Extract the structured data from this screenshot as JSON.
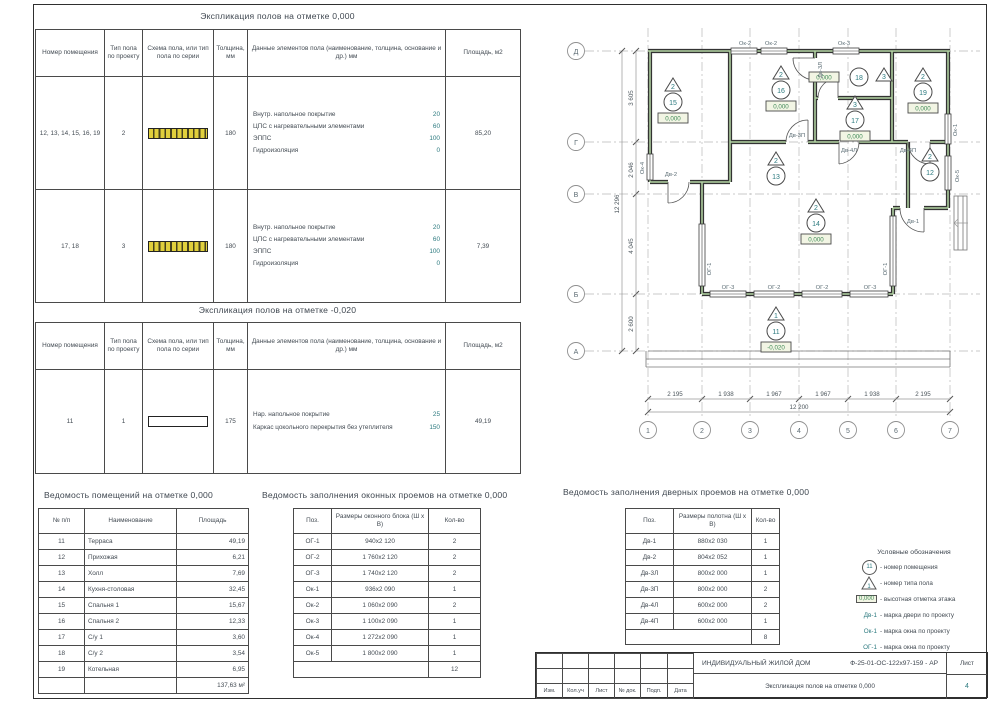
{
  "exp0": {
    "title": "Экспликация полов на отметке 0,000",
    "headers": [
      "Номер помещения",
      "Тип пола по проекту",
      "Схема пола, или тип пола по серии",
      "Толщина, мм",
      "Данные элементов пола (наименование, толщина, основание и др.) мм",
      "Площадь, м2"
    ],
    "rows": [
      {
        "rooms": "12, 13, 14, 15, 16, 19",
        "type": "2",
        "scheme": "hatched",
        "thickness": "180",
        "layers": [
          [
            "Внутр. напольное покрытие",
            "20"
          ],
          [
            "ЦПС с нагревательными элементами",
            "60"
          ],
          [
            "ЭППС",
            "100"
          ],
          [
            "Гидроизоляция",
            "0"
          ]
        ],
        "area": "85,20"
      },
      {
        "rooms": "17, 18",
        "type": "3",
        "scheme": "hatched",
        "thickness": "180",
        "layers": [
          [
            "Внутр. напольное покрытие",
            "20"
          ],
          [
            "ЦПС с нагревательными элементами",
            "60"
          ],
          [
            "ЭППС",
            "100"
          ],
          [
            "Гидроизоляция",
            "0"
          ]
        ],
        "area": "7,39"
      }
    ]
  },
  "expm": {
    "title": "Экспликация полов на отметке -0,020",
    "headers": [
      "Номер помещения",
      "Тип пола по проекту",
      "Схема пола, или тип пола по серии",
      "Толщина, мм",
      "Данные элементов пола (наименование, толщина, основание и др.) мм",
      "Площадь, м2"
    ],
    "rows": [
      {
        "rooms": "11",
        "type": "1",
        "scheme": "plain",
        "thickness": "175",
        "layers": [
          [
            "Нар. напольное покрытие",
            "25"
          ],
          [
            "Каркас цокольного перекрытия без утеплителя",
            "150"
          ]
        ],
        "area": "49,19"
      }
    ]
  },
  "rooms": {
    "title": "Ведомость помещений на отметке 0,000",
    "headers": [
      "№ п/п",
      "Наименование",
      "Площадь"
    ],
    "rows": [
      [
        "11",
        "Терраса",
        "49,19"
      ],
      [
        "12",
        "Прихожая",
        "6,21"
      ],
      [
        "13",
        "Холл",
        "7,69"
      ],
      [
        "14",
        "Кухня-столовая",
        "32,45"
      ],
      [
        "15",
        "Спальня 1",
        "15,67"
      ],
      [
        "16",
        "Спальня 2",
        "12,33"
      ],
      [
        "17",
        "С/у 1",
        "3,60"
      ],
      [
        "18",
        "С/у 2",
        "3,54"
      ],
      [
        "19",
        "Котельная",
        "6,95"
      ]
    ],
    "total": "137,63 м²"
  },
  "windows": {
    "title": "Ведомость заполнения оконных проемов на отметке 0,000",
    "headers": [
      "Поз.",
      "Размеры оконного блока (Ш х В)",
      "Кол-во"
    ],
    "rows": [
      [
        "ОГ-1",
        "940х2 120",
        "2"
      ],
      [
        "ОГ-2",
        "1 760х2 120",
        "2"
      ],
      [
        "ОГ-3",
        "1 740х2 120",
        "2"
      ],
      [
        "Ок-1",
        "936х2 090",
        "1"
      ],
      [
        "Ок-2",
        "1 060х2 090",
        "2"
      ],
      [
        "Ок-3",
        "1 100х2 090",
        "1"
      ],
      [
        "Ок-4",
        "1 272х2 090",
        "1"
      ],
      [
        "Ок-5",
        "1 800х2 090",
        "1"
      ]
    ],
    "total": "12"
  },
  "doors": {
    "title": "Ведомость заполнения дверных проемов на отметке 0,000",
    "headers": [
      "Поз.",
      "Размеры полотна (Ш х В)",
      "Кол-во"
    ],
    "rows": [
      [
        "Дв-1",
        "880х2 030",
        "1"
      ],
      [
        "Дв-2",
        "804х2 052",
        "1"
      ],
      [
        "Дв-3Л",
        "800х2 000",
        "1"
      ],
      [
        "Дв-3П",
        "800х2 000",
        "2"
      ],
      [
        "Дв-4Л",
        "600х2 000",
        "2"
      ],
      [
        "Дв-4П",
        "600х2 000",
        "1"
      ]
    ],
    "total": "8"
  },
  "legend": {
    "title": "Условные обозначения",
    "room_sym": {
      "label": "11",
      "text": "- номер помещения"
    },
    "type_sym": {
      "label": "1",
      "text": "- номер типа пола"
    },
    "elev_sym": {
      "label": "0,000",
      "text": "- высотная отметка этажа"
    },
    "marks": [
      {
        "label": "Дв-1",
        "text": "- марка двери по проекту"
      },
      {
        "label": "Ок-1",
        "text": "- марка окна по проекту"
      },
      {
        "label": "ОГ-1",
        "text": "- марка окна по проекту"
      }
    ]
  },
  "tblock": {
    "project": "ИНДИВИДУАЛЬНЫЙ ЖИЛОЙ ДОМ",
    "code": "Ф-25-01-ОС-122х97-159 - АР",
    "doc_title": "Экспликация полов на отметке 0,000",
    "sheet_label": "Лист",
    "sheet_no": "4",
    "labels": [
      "Изм.",
      "Кол.уч",
      "Лист",
      "№ док.",
      "Подп.",
      "Дата"
    ]
  },
  "plan": {
    "cols": [
      {
        "tf": "translate(92,0)",
        "label": "1"
      },
      {
        "tf": "translate(146,0)",
        "label": "2"
      },
      {
        "tf": "translate(194,0)",
        "label": "3"
      },
      {
        "tf": "translate(243,0)",
        "label": "4"
      },
      {
        "tf": "translate(292,0)",
        "label": "5"
      },
      {
        "tf": "translate(340,0)",
        "label": "6"
      },
      {
        "tf": "translate(394,0)",
        "label": "7"
      }
    ],
    "rows": [
      {
        "tf": "translate(0,45)",
        "label": "Д"
      },
      {
        "tf": "translate(0,136)",
        "label": "Г"
      },
      {
        "tf": "translate(0,188)",
        "label": "В"
      },
      {
        "tf": "translate(0,288)",
        "label": "Б"
      },
      {
        "tf": "translate(0,345)",
        "label": "А"
      }
    ],
    "v_dims": [
      {
        "tf": "translate(77,92) rotate(-90)",
        "label": "3 605"
      },
      {
        "tf": "translate(77,164) rotate(-90)",
        "label": "2 046"
      },
      {
        "tf": "translate(77,240) rotate(-90)",
        "label": "4 045"
      },
      {
        "tf": "translate(77,318) rotate(-90)",
        "label": "2 600"
      }
    ],
    "v_total": "12 296",
    "h_dims": [
      {
        "tf": "translate(119,390)",
        "label": "2 195"
      },
      {
        "tf": "translate(170,390)",
        "label": "1 938"
      },
      {
        "tf": "translate(218,390)",
        "label": "1 967"
      },
      {
        "tf": "translate(267,390)",
        "label": "1 967"
      },
      {
        "tf": "translate(316,390)",
        "label": "1 938"
      },
      {
        "tf": "translate(367,390)",
        "label": "2 195"
      }
    ],
    "h_total": "12 200",
    "markers": [
      {
        "tf": "translate(117,86)",
        "type": "2",
        "room": "15",
        "elev": "0,000"
      },
      {
        "tf": "translate(225,74)",
        "type": "2",
        "room": "16",
        "elev": "0,000"
      },
      {
        "tf": "translate(299,104)",
        "type": "3",
        "room": "17",
        "elev": "0,000"
      },
      {
        "tf": "translate(367,76)",
        "type": "2",
        "room": "19",
        "elev": "0,000"
      },
      {
        "tf": "translate(260,207)",
        "type": "2",
        "room": "14",
        "elev": "0,000"
      },
      {
        "tf": "translate(220,315)",
        "type": "1",
        "room": "11",
        "elev": "-0,020"
      }
    ],
    "markers_plain": [
      {
        "tf": "translate(220,160)",
        "type": "2",
        "room": "13"
      },
      {
        "tf": "translate(374,156)",
        "type": "2",
        "room": "12"
      }
    ],
    "room18": {
      "room": "18",
      "type": "3",
      "elev": "0,000"
    },
    "labels": [
      {
        "tf": "translate(189,39)",
        "label": "Ок-2"
      },
      {
        "tf": "translate(215,39)",
        "label": "Ок-2"
      },
      {
        "tf": "translate(288,39)",
        "label": "Ок-3"
      },
      {
        "tf": "translate(88,162) rotate(-90)",
        "label": "Ок-4"
      },
      {
        "tf": "translate(401,124) rotate(-90)",
        "label": "Ок-1"
      },
      {
        "tf": "translate(403,170) rotate(-90)",
        "label": "Ок-5"
      },
      {
        "tf": "translate(155,263) rotate(-90)",
        "label": "ОГ-1"
      },
      {
        "tf": "translate(172,283)",
        "label": "ОГ-3"
      },
      {
        "tf": "translate(218,283)",
        "label": "ОГ-2"
      },
      {
        "tf": "translate(266,283)",
        "label": "ОГ-2"
      },
      {
        "tf": "translate(314,283)",
        "label": "ОГ-3"
      },
      {
        "tf": "translate(331,263) rotate(-90)",
        "label": "ОГ-1"
      },
      {
        "tf": "translate(115,170)",
        "label": "Дв-2"
      },
      {
        "tf": "translate(241,131)",
        "label": "Дв-3П"
      },
      {
        "tf": "translate(266,64) rotate(-90)",
        "label": "Дв-3Л"
      },
      {
        "tf": "translate(293,146)",
        "label": "Дв-4Л"
      },
      {
        "tf": "translate(352,146)",
        "label": "Дв-4П"
      },
      {
        "tf": "translate(357,217)",
        "label": "Дв-1"
      }
    ]
  }
}
